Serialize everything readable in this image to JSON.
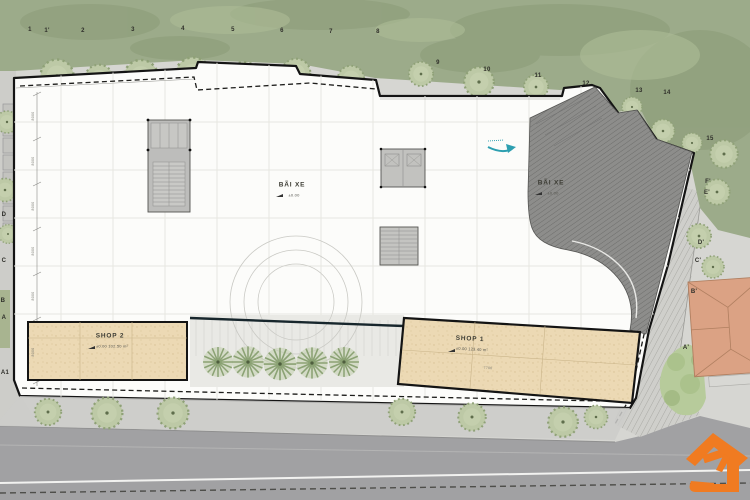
{
  "drawing": {
    "type": "architectural-site-plan",
    "parking_left": {
      "label": "BÃI XE",
      "elevation": "±0.00"
    },
    "parking_right": {
      "label": "BÃI XE",
      "elevation": "±0.00"
    },
    "shop1": {
      "label": "SHOP 1",
      "info": "±0.00   123.40 m²",
      "dim": "7700"
    },
    "shop2": {
      "label": "SHOP 2",
      "info": "±0.00   102.50 m²"
    }
  },
  "grid": {
    "top_labels": [
      "1",
      "1'",
      "2",
      "3",
      "4",
      "5",
      "6",
      "7",
      "8",
      "9",
      "10",
      "11",
      "12",
      "13",
      "14",
      "15"
    ],
    "left_labels": [
      "D",
      "C",
      "B",
      "A",
      "A1"
    ],
    "right_labels": [
      "F'",
      "E'",
      "D'",
      "C'",
      "B'",
      "A'"
    ],
    "bay_dim": "8000"
  },
  "icons": {
    "ramp_arrow": "basement-ramp-direction",
    "logo": "orange-house-logo"
  },
  "colors": {
    "logo_orange": "#F07B21",
    "arrow_teal": "#2D9FB0",
    "neighbor_roof": "#DBA284",
    "shop_tan": "#ECD9B4",
    "forest_green": "#9CAB8A"
  }
}
